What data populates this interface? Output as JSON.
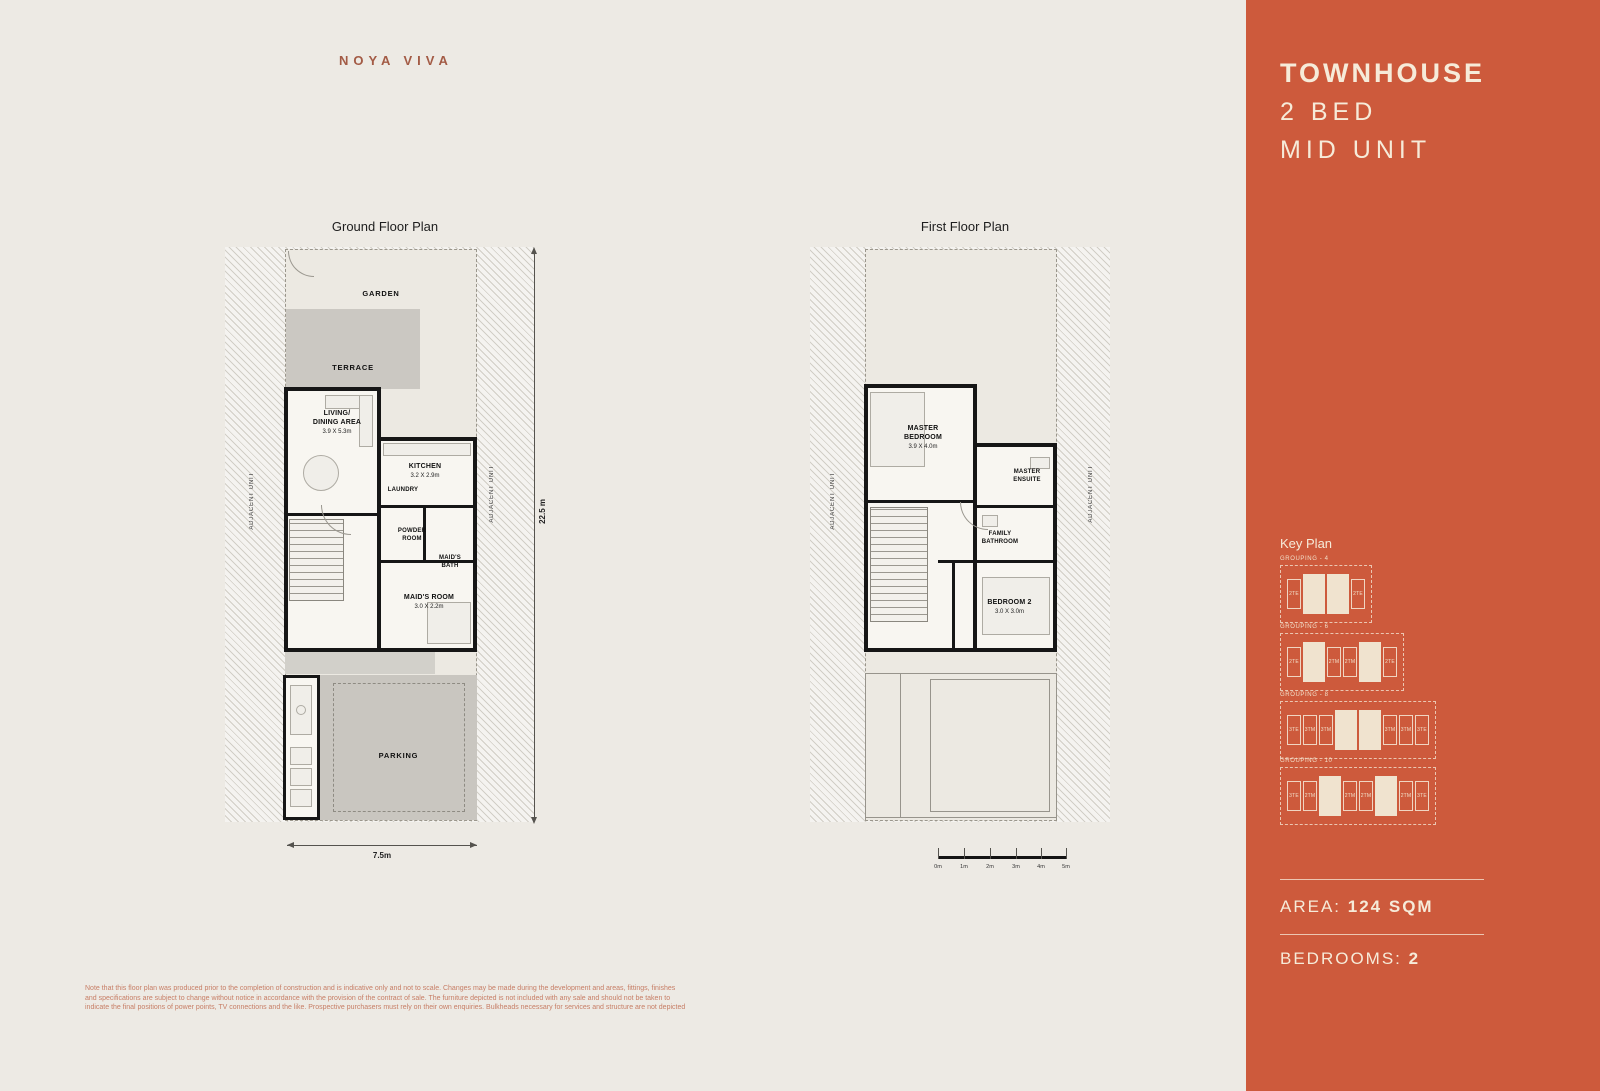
{
  "brand": "NOYA VIVA",
  "colors": {
    "panel_bg": "#CD5A3C",
    "panel_text": "#F6EBD9",
    "page_bg": "#EDEAE4",
    "brand_text": "#A35B45",
    "disclaimer_text": "#C77E66"
  },
  "panel": {
    "title1": "TOWNHOUSE",
    "title2": "2 BED",
    "title3": "MID UNIT",
    "key_plan": "Key Plan",
    "groupings": [
      {
        "label": "GROUPING - 4",
        "units": [
          {
            "t": "2TE",
            "filled": false
          },
          {
            "t": "",
            "filled": true
          },
          {
            "t": "",
            "filled": true
          },
          {
            "t": "2TE",
            "filled": false
          }
        ]
      },
      {
        "label": "GROUPING - 6",
        "units": [
          {
            "t": "2TE",
            "filled": false
          },
          {
            "t": "",
            "filled": true
          },
          {
            "t": "2TM",
            "filled": false
          },
          {
            "t": "2TM",
            "filled": false
          },
          {
            "t": "",
            "filled": true
          },
          {
            "t": "2TE",
            "filled": false
          }
        ]
      },
      {
        "label": "GROUPING - 8",
        "units": [
          {
            "t": "3TE",
            "filled": false
          },
          {
            "t": "3TM",
            "filled": false
          },
          {
            "t": "3TM",
            "filled": false
          },
          {
            "t": "",
            "filled": true
          },
          {
            "t": "",
            "filled": true
          },
          {
            "t": "3TM",
            "filled": false
          },
          {
            "t": "3TM",
            "filled": false
          },
          {
            "t": "3TE",
            "filled": false
          }
        ]
      },
      {
        "label": "GROUPING - 10",
        "units": [
          {
            "t": "3TE",
            "filled": false
          },
          {
            "t": "2TM",
            "filled": false
          },
          {
            "t": "",
            "filled": true
          },
          {
            "t": "2TM",
            "filled": false
          },
          {
            "t": "2TM",
            "filled": false
          },
          {
            "t": "",
            "filled": true
          },
          {
            "t": "2TM",
            "filled": false
          },
          {
            "t": "3TE",
            "filled": false
          }
        ]
      }
    ],
    "area_label": "AREA:",
    "area_value": "124 SQM",
    "bedrooms_label": "BEDROOMS:",
    "bedrooms_value": "2"
  },
  "ground_floor": {
    "title": "Ground Floor Plan",
    "garden": "GARDEN",
    "terrace": "TERRACE",
    "parking": "PARKING",
    "living_name": "LIVING/\nDINING AREA",
    "living_dims": "3.9 X 5.3m",
    "kitchen_name": "KITCHEN",
    "kitchen_dims": "3.2 X 2.9m",
    "laundry_name": "LAUNDRY",
    "powder_name": "POWDER\nROOM",
    "maids_bath_name": "MAID'S\nBATH",
    "maids_room_name": "MAID'S ROOM",
    "maids_room_dims": "3.0 X 2.2m",
    "adjacent_left": "ADJACENT UNIT",
    "adjacent_right": "ADJACENT UNIT",
    "dim_height": "22.5 m",
    "dim_width": "7.5m"
  },
  "first_floor": {
    "title": "First Floor Plan",
    "master_name": "MASTER\nBEDROOM",
    "master_dims": "3.9 X 4.0m",
    "ensuite_name": "MASTER\nENSUITE",
    "family_bath_name": "FAMILY\nBATHROOM",
    "bedroom2_name": "BEDROOM 2",
    "bedroom2_dims": "3.0 X 3.0m",
    "adjacent_left": "ADJACENT UNIT",
    "adjacent_right": "ADJACENT UNIT",
    "scale_labels": [
      "0m",
      "1m",
      "2m",
      "3m",
      "4m",
      "5m"
    ]
  },
  "disclaimer": {
    "line1": "Note that this floor plan was produced prior to the completion of construction and is indicative only and not to scale. Changes may be made during the development and areas, fittings, finishes",
    "line2": "and specifications are subject to change without notice in accordance with the provision of the contract of sale. The furniture depicted is not included with any sale and should not be taken to",
    "line3": "indicate the final positions of power points, TV connections and the like. Prospective purchasers must rely on their own enquiries. Bulkheads necessary for services and structure are not depicted"
  }
}
